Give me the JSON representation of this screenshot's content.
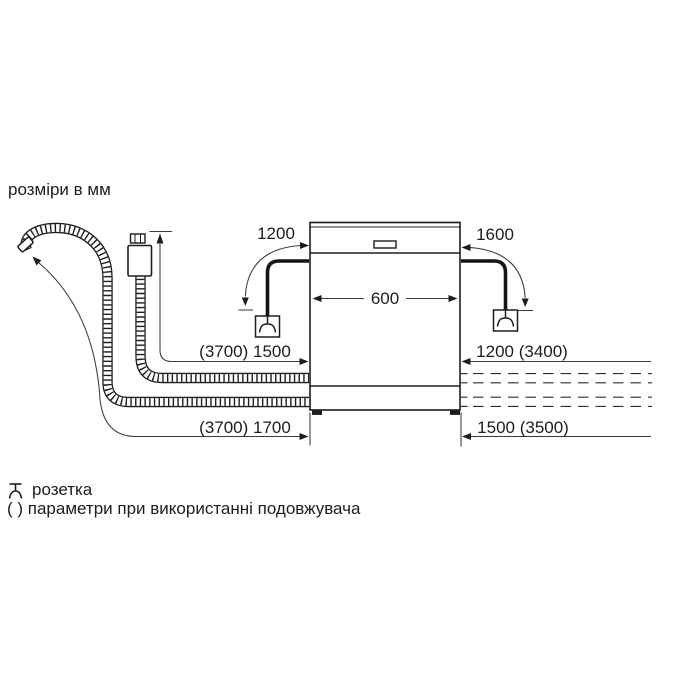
{
  "title": "розміри в мм",
  "dimensions": {
    "power_cord_left": "1200",
    "power_cord_right": "1600",
    "appliance_width": "600",
    "inlet_hose": "(3700) 1500",
    "right_upper": "1200 (3400)",
    "drain_hose": "(3700) 1700",
    "right_lower": "1500 (3500)"
  },
  "legend": {
    "socket": "розетка",
    "extension": "( ) параметри при використанні подовжувача"
  },
  "icons": {
    "socket": "socket-icon",
    "aquastop": "aquastop-valve-icon",
    "drain_hose": "corrugated-drain-hose",
    "inlet_hose": "corrugated-inlet-hose"
  },
  "colors": {
    "line": "#1d1d1d",
    "dimension_line": "#3a3a3a",
    "background": "#ffffff"
  }
}
